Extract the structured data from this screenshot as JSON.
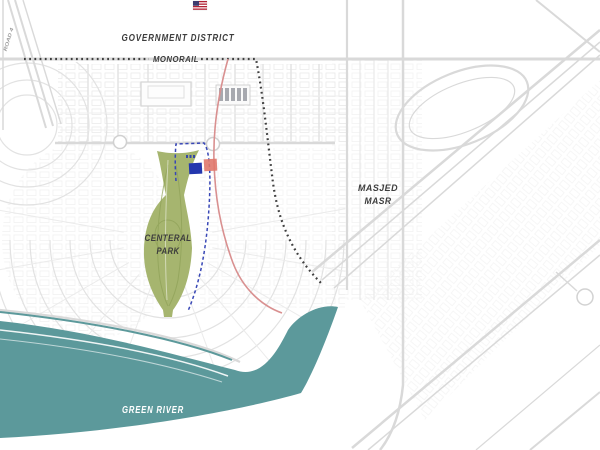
{
  "map": {
    "labels": {
      "district": "GOVERNMENT DISTRICT",
      "monorail": "MONORAIL",
      "park": [
        "CENTERAL",
        "PARK"
      ],
      "mosque": [
        "MASJED",
        "MASR"
      ],
      "river": "GREEN RIVER",
      "road": "ROAD 4"
    },
    "colors": {
      "river": "#5C999B",
      "park": "#A6B56F",
      "park_detail": "#8EA157",
      "monorail_line": "#3F3F3F",
      "boundary_blue": "#3847B6",
      "route_red": "#D99090",
      "plot_blue": "#2437AE",
      "plot_red": "#E0786C",
      "label_dark": "#3D3D3D",
      "label_light": "#FFFFFF",
      "road_gray": "#D9D9D9",
      "flag_blue": "#3C3B6E",
      "flag_red": "#B22234"
    }
  }
}
